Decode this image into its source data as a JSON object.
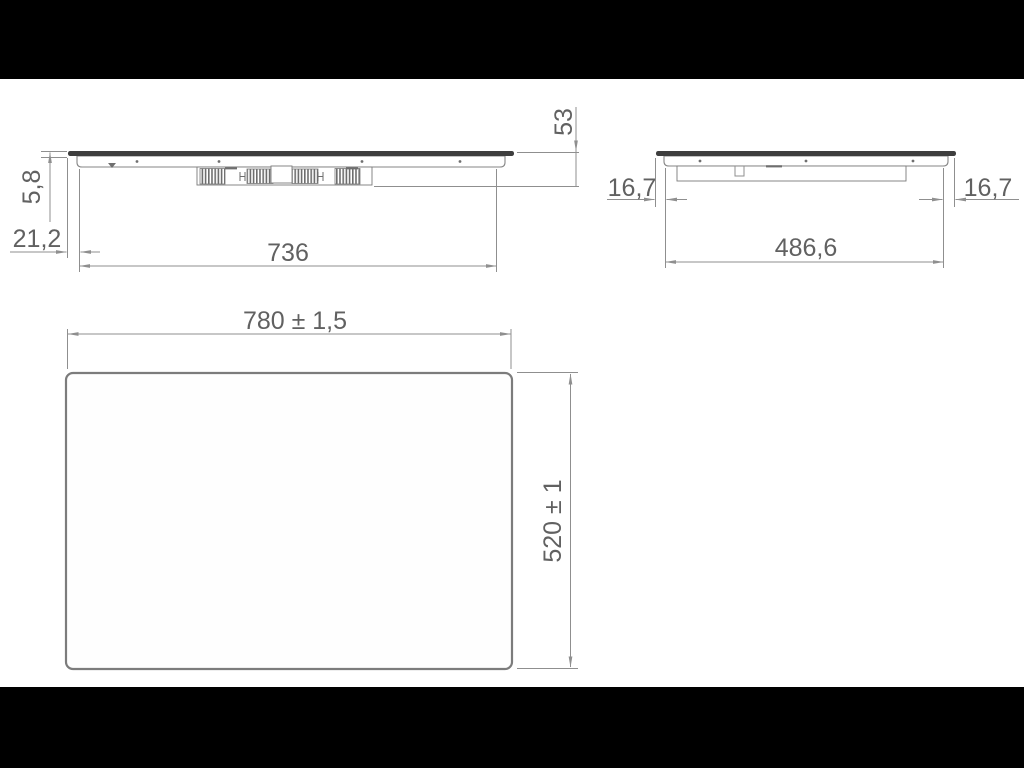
{
  "drawing_title": "cooktop installation dimension drawing",
  "dimensions": {
    "front_view": {
      "glass_thickness": "5,8",
      "edge_offset": "21,2",
      "body_width": "736",
      "total_height": "53"
    },
    "side_view": {
      "overhang_left": "16,7",
      "body_depth": "486,6",
      "overhang_right": "16,7"
    },
    "top_view": {
      "overall_width": "780 ± 1,5",
      "overall_depth": "520 ± 1"
    }
  },
  "colors": {
    "letterbox": "#000000",
    "canvas": "#ffffff",
    "line": "#8f8f8f",
    "text": "#616161",
    "glass": "#3e3e3e"
  }
}
